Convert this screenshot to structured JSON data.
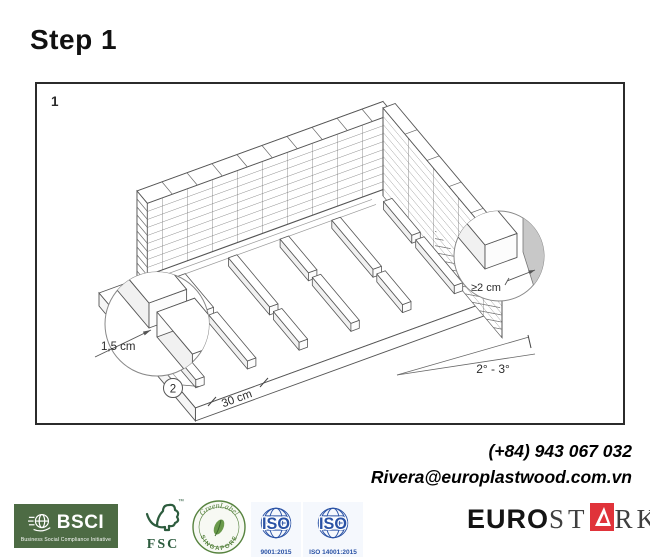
{
  "title": "Step 1",
  "figure": {
    "panel_number": "1",
    "callout_number": "2",
    "dim_joist_end_gap": "1,5 cm",
    "dim_wall_gap": "≥2 cm",
    "dim_spacing": "30 cm",
    "dim_slope": "2° - 3°"
  },
  "contact": {
    "phone": "(+84) 943 067 032",
    "email": "Rivera@europlastwood.com.vn"
  },
  "footer": {
    "bsci": {
      "name": "BSCI",
      "tagline": "Business Social Compliance Initiative"
    },
    "fsc": {
      "name": "FSC",
      "tm": "™"
    },
    "greenlabel": {
      "arc_top": "GreenLabel",
      "arc_bottom": "SINGAPORE"
    },
    "iso9001": {
      "name": "ISO",
      "caption": "9001:2015"
    },
    "iso14001": {
      "name": "ISO",
      "caption": "ISO 14001:2015"
    },
    "eurostark": {
      "part1": "EURO",
      "part2": "ST",
      "part3": "RK"
    }
  },
  "colors": {
    "bsci_green": "#4d6b44",
    "fsc_green": "#2d5c3e",
    "greenlabel_green": "#57833f",
    "iso_blue": "#2a52a5",
    "eurostark_red": "#e0333a",
    "diagram_line": "#555555",
    "detail_wall_gray": "#c8c8c8"
  }
}
